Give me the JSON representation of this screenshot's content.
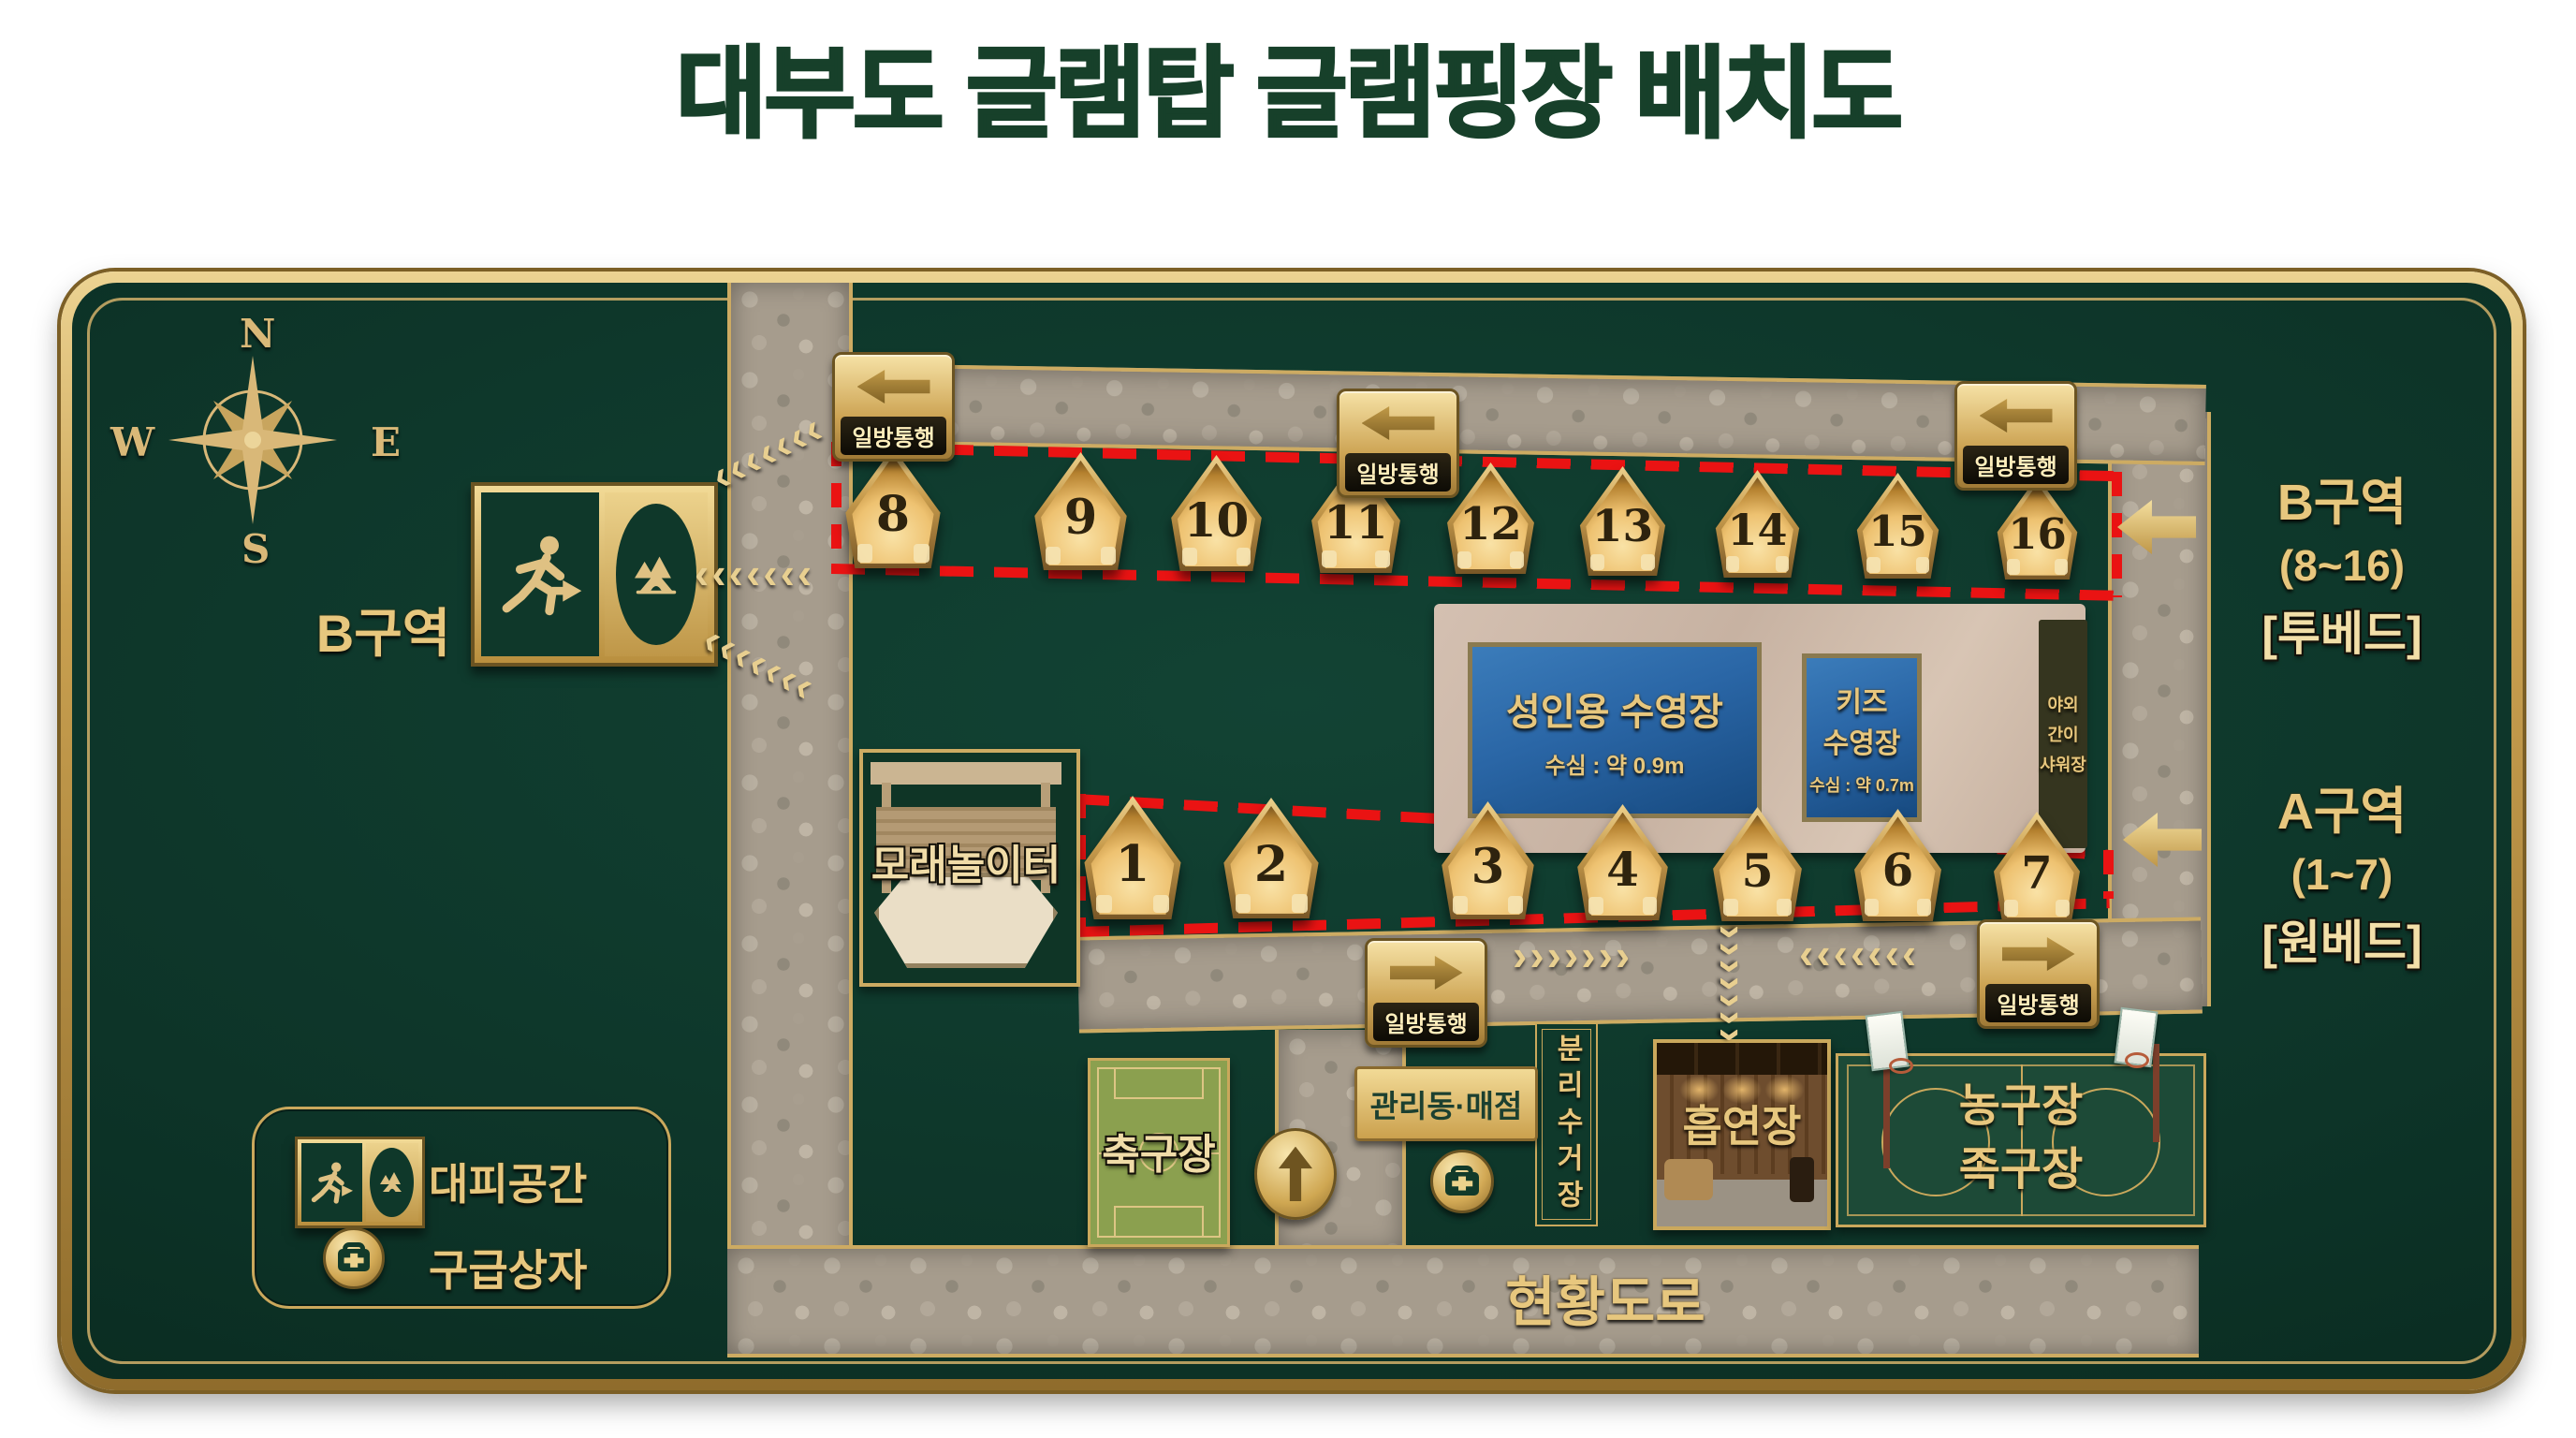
{
  "title": "대부도 글램탑 글램핑장 배치도",
  "compass": {
    "n": "N",
    "e": "E",
    "s": "S",
    "w": "W"
  },
  "map": {
    "one_way": "일방통행",
    "zone_b_sign": "B구역",
    "zone_b_side": {
      "l1": "B구역",
      "l2": "(8~16)",
      "l3": "[투베드]"
    },
    "zone_a_side": {
      "l1": "A구역",
      "l2": "(1~7)",
      "l3": "[원베드]"
    },
    "tents_b": [
      8,
      9,
      10,
      11,
      12,
      13,
      14,
      15,
      16
    ],
    "tents_a": [
      1,
      2,
      3,
      4,
      5,
      6,
      7
    ],
    "adult_pool": {
      "name": "성인용 수영장",
      "depth": "수심 : 약 0.9m"
    },
    "kids_pool": {
      "l1": "키즈",
      "l2": "수영장",
      "depth": "수심 : 약 0.7m"
    },
    "shower": {
      "l1": "야외",
      "l2": "간이",
      "l3": "샤워장"
    },
    "sand": "모래놀이터",
    "soccer": "축구장",
    "office": "관리동·매점",
    "recycle": "분리수거장",
    "smoking": "흡연장",
    "court": {
      "l1": "농구장",
      "l2": "족구장"
    },
    "road": "현황도로"
  },
  "legend": {
    "evacuation": "대피공간",
    "first_aid": "구급상자"
  },
  "icons": {
    "chevron_left": "‹",
    "chevron_right": "›"
  },
  "colors": {
    "board_green": "#0d3428",
    "gold": "#d9b878",
    "red_dash": "#ea1313",
    "pool_blue": "#2a66a6",
    "stone": "#a69c8d",
    "title_green": "#17402a"
  }
}
